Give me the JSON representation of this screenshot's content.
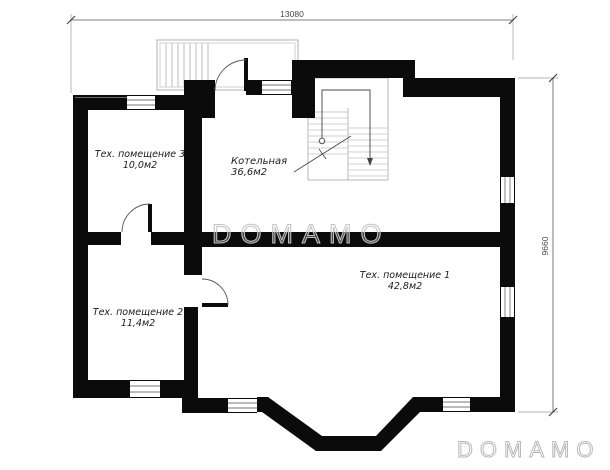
{
  "plan": {
    "watermark_center": "DOMAMO",
    "watermark_bottom_right": "DOMAMO",
    "dimensions": {
      "top_width": "13080",
      "right_height": "9660"
    },
    "rooms": [
      {
        "id": "room-3",
        "name": "Тех. помещение 3",
        "area": "10,0м2"
      },
      {
        "id": "boiler",
        "name": "Котельная",
        "area": "36,6м2"
      },
      {
        "id": "room-2",
        "name": "Тех. помещение 2",
        "area": "11,4м2"
      },
      {
        "id": "room-1",
        "name": "Тех. помещение 1",
        "area": "42,8м2"
      }
    ]
  }
}
